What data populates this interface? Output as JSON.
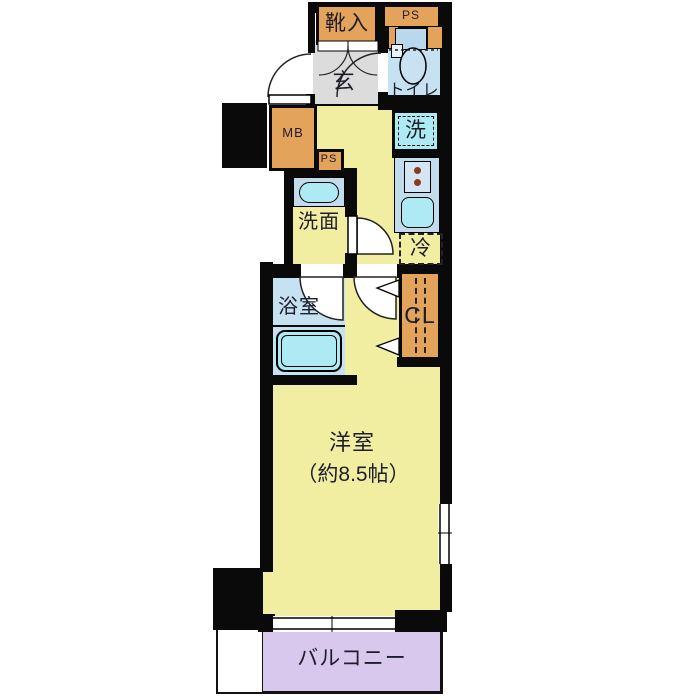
{
  "labels": {
    "shoe_cabinet": "靴入",
    "ps_top": "PS",
    "entrance": "玄",
    "toilet": "トイレ",
    "meter_box": "MB",
    "ps_small": "PS",
    "washer": "洗",
    "washroom": "洗面",
    "refrigerator": "冷",
    "bathroom": "浴室",
    "closet": "CL",
    "main_room": "洋室",
    "main_room_size": "（約8.5帖）",
    "balcony": "バルコニー"
  },
  "colors": {
    "wall": "#0a0a0a",
    "floor_yellow": "#f1eea2",
    "genkan_gray": "#dcdcdc",
    "wet_blue": "#c6e1f2",
    "counter_blue": "#c2dcee",
    "fixture_cyan": "#aeeaf4",
    "cabinet_orange": "#e3a35b",
    "balcony_lavender": "#d9c8ee"
  }
}
